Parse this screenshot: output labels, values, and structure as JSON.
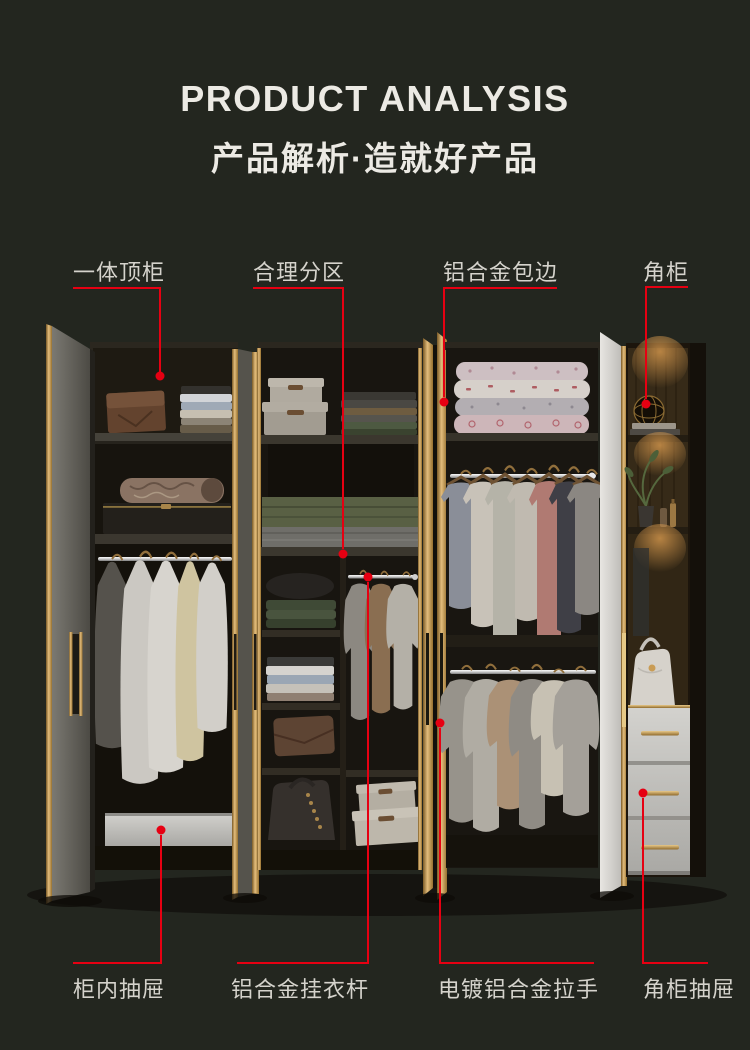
{
  "header": {
    "title": "PRODUCT ANALYSIS",
    "subtitle": "产品解析·造就好产品"
  },
  "callouts": {
    "top": [
      {
        "id": "integrated-top-cabinet",
        "label": "一体顶柜"
      },
      {
        "id": "reasonable-zoning",
        "label": "合理分区"
      },
      {
        "id": "aluminum-alloy-edging",
        "label": "铝合金包边"
      },
      {
        "id": "corner-cabinet",
        "label": "角柜"
      }
    ],
    "bottom": [
      {
        "id": "in-cabinet-drawer",
        "label": "柜内抽屉"
      },
      {
        "id": "aluminum-hanging-rod",
        "label": "铝合金挂衣杆"
      },
      {
        "id": "plated-aluminum-handle",
        "label": "电镀铝合金拉手"
      },
      {
        "id": "corner-cabinet-drawer",
        "label": "角柜抽屉"
      }
    ]
  },
  "colors": {
    "bg": "#23261f",
    "heading": "#eceae4",
    "label": "#d5d3cc",
    "accent": "#e60012",
    "gold": "#d4a960"
  }
}
